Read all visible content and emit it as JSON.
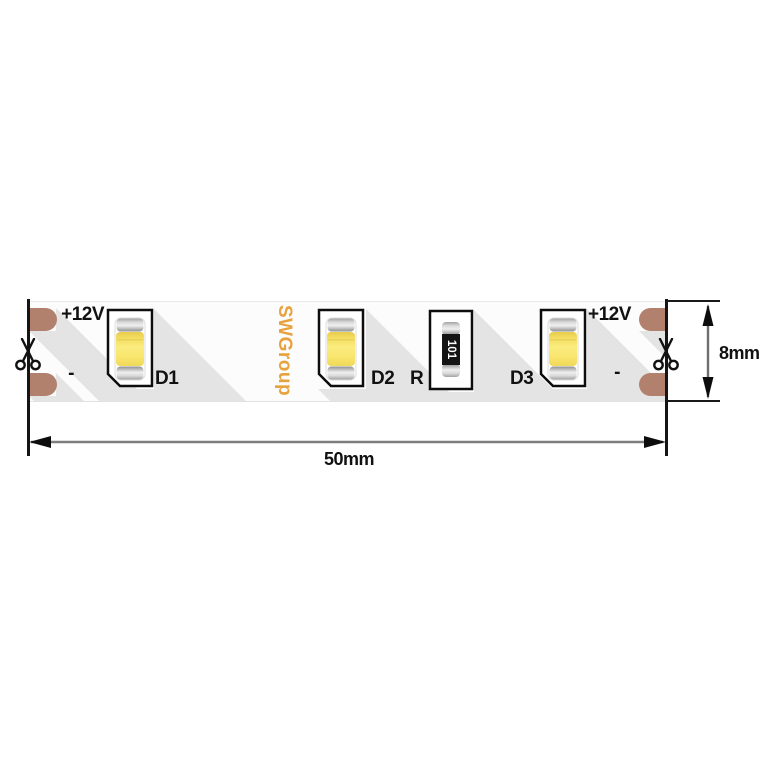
{
  "diagram": {
    "brand": "SWGroup",
    "strip": {
      "terminals_left": {
        "positive": "+12V",
        "negative": "-"
      },
      "terminals_right": {
        "positive": "+12V",
        "negative": "-"
      },
      "components": {
        "led1": "D1",
        "led2": "D2",
        "led3": "D3",
        "resistor": "R",
        "resistor_value": "101"
      }
    },
    "dimensions": {
      "length": "50mm",
      "height": "8mm"
    },
    "colors": {
      "pad_copper": "#b2816d",
      "brand_text": "#e8a23d",
      "led_yellow": "#f7e466",
      "shadow": "#e4e4e4"
    }
  }
}
